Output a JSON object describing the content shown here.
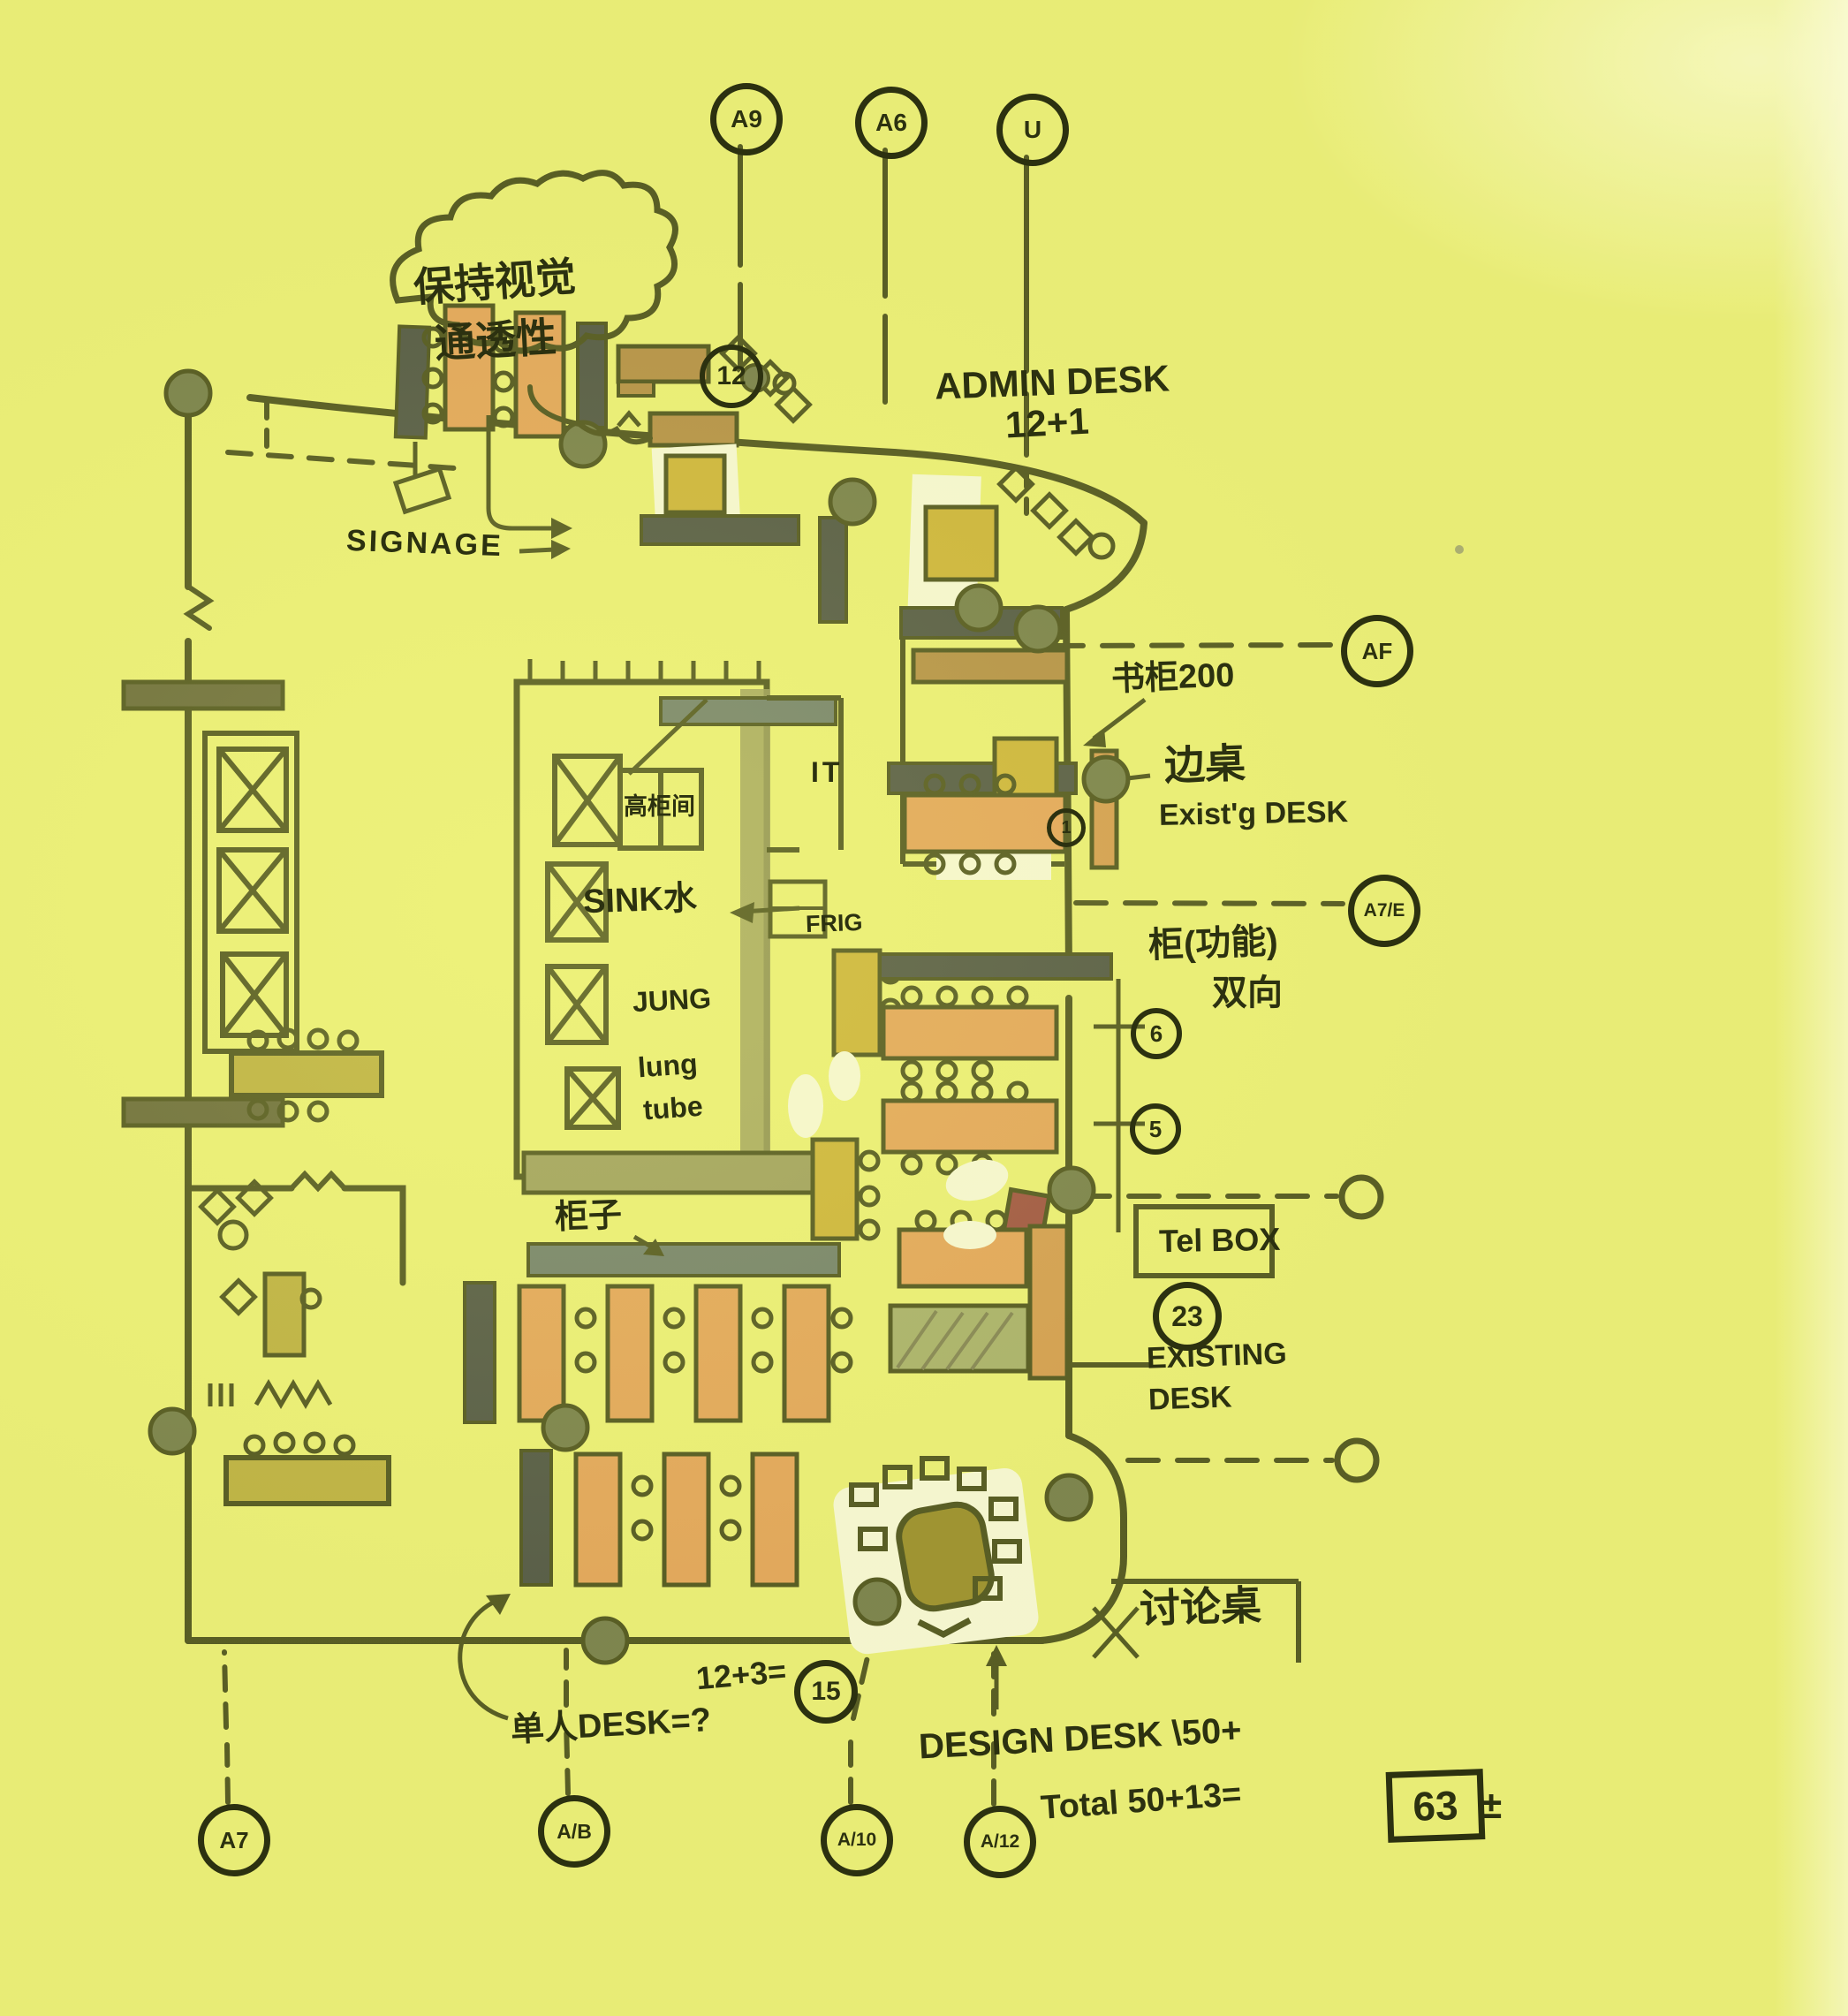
{
  "colors": {
    "paper": "#ecf07c",
    "ink": "#2c3110",
    "desk_orange": "#e2955a",
    "desk_tan": "#a87a42",
    "cabinet_navy": "#2e3440",
    "counter_mustard": "#c7a733",
    "wall_sage": "#8e8e5f",
    "column_olive": "#5d6647",
    "table_olive": "#b3a33c",
    "cabinet_slate": "#57676f",
    "accent_red": "#8e2f3c",
    "whiteout": "#fbfbf2"
  },
  "cloud": {
    "line1": "保持视觉",
    "line2": "通透性"
  },
  "notes": {
    "signage": "SIGNAGE",
    "admin_line1": "ADMIN DESK",
    "admin_line2": "12+1",
    "bookcase": "书柜200",
    "side_table": "边桌",
    "existing_small": "Exist'g DESK",
    "cabinet_function": "柜(功能)",
    "two_way": "双向",
    "it_room": "IT",
    "sink": "SINK水",
    "frig": "FRIG",
    "jung": "JUNG",
    "lung_line1": "lung",
    "lung_line2": "tube",
    "tall_cabinet": "高柜间",
    "cabinet": "柜子",
    "tel_box": "Tel BOX",
    "existing_line1": "EXISTING",
    "existing_line2": "DESK",
    "discussion": "讨论桌",
    "eq15_prefix": "12+3=",
    "single_desk": "单人DESK=?",
    "design_desk": "DESIGN DESK \\50+",
    "total_prefix": "Total 50+13=",
    "total_boxed": "63",
    "total_suffix": "±"
  },
  "markers": {
    "top": [
      "A9",
      "A6",
      "U"
    ],
    "right": [
      "AF",
      "A7/E"
    ],
    "bottom": [
      "A7",
      "A/B",
      "A/10",
      "A/12"
    ]
  },
  "circled": {
    "n12": "12",
    "n1": "1",
    "n6": "6",
    "n5": "5",
    "n23": "23",
    "n15": "15"
  }
}
